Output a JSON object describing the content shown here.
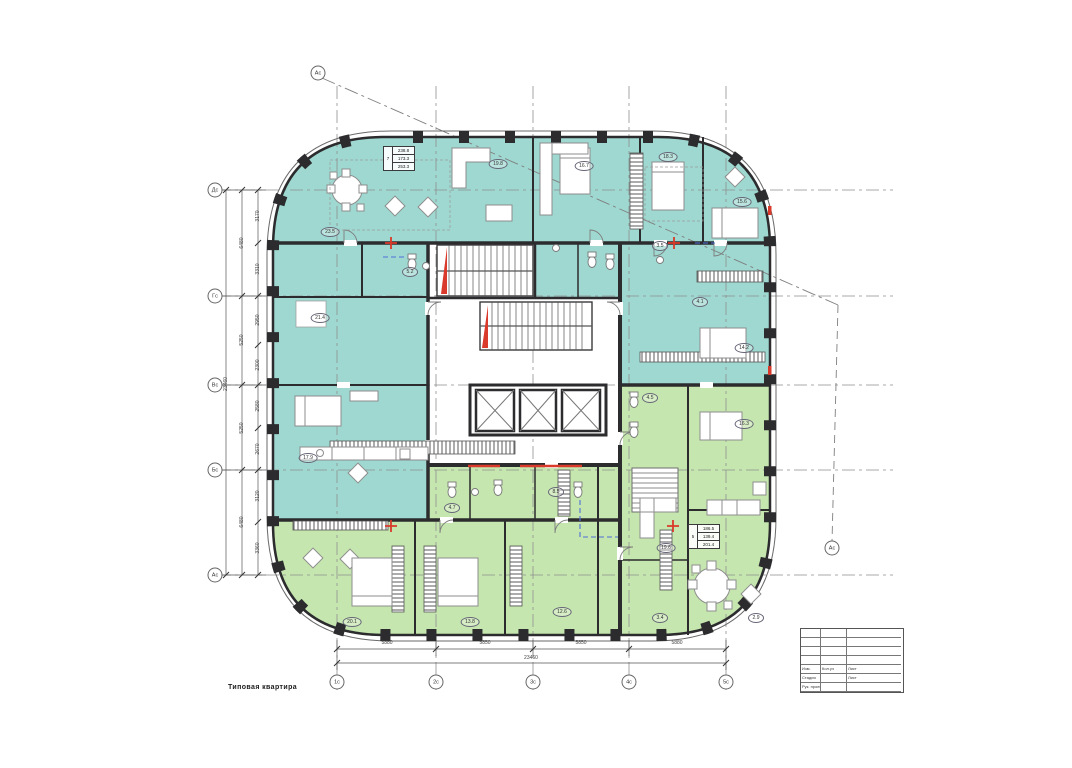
{
  "colors": {
    "apartment_teal": "#9fd8d0",
    "apartment_green": "#c5e6ae",
    "wall": "#2c2c2f",
    "accent_red": "#d93a2b",
    "grid_blue": "#4f6fd8"
  },
  "caption": "Типовая квартира",
  "axes": {
    "left": [
      {
        "label": "Дс",
        "x": 215,
        "y": 190
      },
      {
        "label": "Гс",
        "x": 215,
        "y": 296
      },
      {
        "label": "Вс",
        "x": 215,
        "y": 385
      },
      {
        "label": "Бс",
        "x": 215,
        "y": 470
      },
      {
        "label": "Ас",
        "x": 215,
        "y": 575
      }
    ],
    "bottom": [
      {
        "label": "1с",
        "x": 337,
        "y": 682
      },
      {
        "label": "2с",
        "x": 436,
        "y": 682
      },
      {
        "label": "3с",
        "x": 533,
        "y": 682
      },
      {
        "label": "4с",
        "x": 629,
        "y": 682
      },
      {
        "label": "5с",
        "x": 726,
        "y": 682
      }
    ],
    "section": [
      {
        "label": "Ас",
        "x": 318,
        "y": 73
      },
      {
        "label": "Ас",
        "x": 832,
        "y": 548
      }
    ]
  },
  "dimensions": {
    "left_total": {
      "label": "23460",
      "x": 226,
      "y": 384
    },
    "left_segments": [
      {
        "label": "6480",
        "x": 242,
        "y": 243
      },
      {
        "label": "5250",
        "x": 242,
        "y": 340
      },
      {
        "label": "5250",
        "x": 242,
        "y": 428
      },
      {
        "label": "6480",
        "x": 242,
        "y": 522
      }
    ],
    "left_subsegments": [
      {
        "label": "3170",
        "x": 258,
        "y": 216
      },
      {
        "label": "3310",
        "x": 258,
        "y": 269
      },
      {
        "label": "2950",
        "x": 258,
        "y": 320
      },
      {
        "label": "2300",
        "x": 258,
        "y": 365
      },
      {
        "label": "2580",
        "x": 258,
        "y": 406
      },
      {
        "label": "2670",
        "x": 258,
        "y": 449
      },
      {
        "label": "3120",
        "x": 258,
        "y": 496
      },
      {
        "label": "3360",
        "x": 258,
        "y": 548
      }
    ],
    "bottom_segments": [
      {
        "label": "5880",
        "x": 387,
        "y": 646
      },
      {
        "label": "5850",
        "x": 485,
        "y": 646
      },
      {
        "label": "5850",
        "x": 581,
        "y": 646
      },
      {
        "label": "5880",
        "x": 677,
        "y": 646
      }
    ],
    "bottom_total": {
      "label": "23460",
      "x": 531,
      "y": 661
    }
  },
  "area_labels": [
    {
      "label": "23.5",
      "x": 330,
      "y": 232
    },
    {
      "label": "19.8",
      "x": 498,
      "y": 164
    },
    {
      "label": "16.7",
      "x": 584,
      "y": 166
    },
    {
      "label": "18.3",
      "x": 668,
      "y": 157
    },
    {
      "label": "15.6",
      "x": 742,
      "y": 202
    },
    {
      "label": "21.4",
      "x": 320,
      "y": 318
    },
    {
      "label": "5.2",
      "x": 410,
      "y": 272
    },
    {
      "label": "17.9",
      "x": 308,
      "y": 458
    },
    {
      "label": "14.2",
      "x": 744,
      "y": 348
    },
    {
      "label": "3.5",
      "x": 660,
      "y": 246
    },
    {
      "label": "4.1",
      "x": 700,
      "y": 302
    },
    {
      "label": "20.1",
      "x": 352,
      "y": 622
    },
    {
      "label": "13.8",
      "x": 470,
      "y": 622
    },
    {
      "label": "12.6",
      "x": 562,
      "y": 612
    },
    {
      "label": "3.4",
      "x": 660,
      "y": 618
    },
    {
      "label": "2.9",
      "x": 756,
      "y": 618
    },
    {
      "label": "4.5",
      "x": 650,
      "y": 398
    },
    {
      "label": "16.3",
      "x": 744,
      "y": 424
    },
    {
      "label": "8.5",
      "x": 556,
      "y": 492
    },
    {
      "label": "4.7",
      "x": 452,
      "y": 508
    },
    {
      "label": "19.6",
      "x": 666,
      "y": 548
    }
  ],
  "stamps": {
    "one": {
      "rooms": "7",
      "r1": "238.8",
      "r2": "173.3",
      "r3": "253.3"
    },
    "two": {
      "rooms": "5",
      "r1": "186.5",
      "r2": "139.4",
      "r3": "201.4"
    }
  },
  "title_block": {
    "cells": [
      [
        "Изм.",
        "Кол.уч",
        "Лист"
      ],
      [
        "Стадия",
        "",
        "Лист"
      ],
      [
        "Рук. проекта",
        "",
        ""
      ]
    ]
  }
}
